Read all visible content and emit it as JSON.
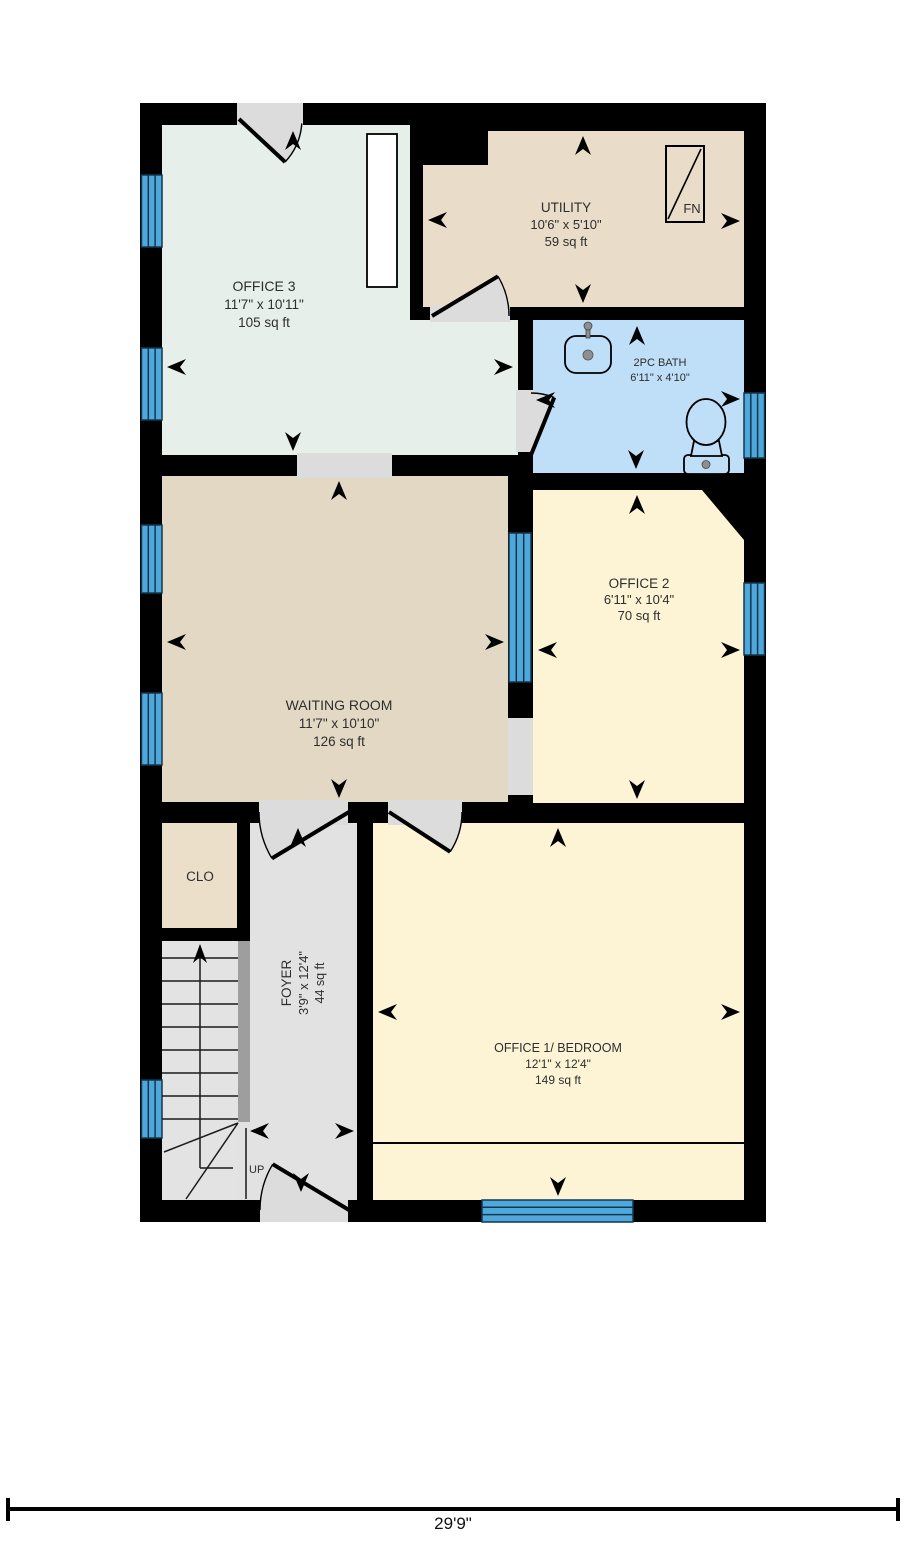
{
  "plan": {
    "scale_label": "29'9\"",
    "up_label": "UP",
    "furnace_label": "FN",
    "rooms": {
      "office3": {
        "name": "OFFICE 3",
        "dims": "11'7\" x 10'11\"",
        "area": "105 sq ft",
        "color": "#e6efe9"
      },
      "utility": {
        "name": "UTILITY",
        "dims": "10'6\" x 5'10\"",
        "area": "59 sq ft",
        "color": "#e9dcc8"
      },
      "bath": {
        "name": "2PC BATH",
        "dims": "6'11\" x 4'10\"",
        "color": "#bfdef7"
      },
      "office2": {
        "name": "OFFICE 2",
        "dims": "6'11\" x 10'4\"",
        "area": "70 sq ft",
        "color": "#fdf4d6"
      },
      "waiting": {
        "name": "WAITING ROOM",
        "dims": "11'7\" x 10'10\"",
        "area": "126 sq ft",
        "color": "#e3d8c4"
      },
      "clo": {
        "name": "CLO",
        "color": "#ebdfca"
      },
      "foyer": {
        "name": "FOYER",
        "dims": "3'9\" x 12'4\"",
        "area": "44 sq ft",
        "color": "#e2e2e2"
      },
      "office1": {
        "name": "OFFICE 1/ BEDROOM",
        "dims": "12'1\" x 12'4\"",
        "area": "149 sq ft",
        "color": "#fdf4d6"
      }
    },
    "colors": {
      "background": "#ffffff",
      "wall": "#000000",
      "window": "#4fa8dc",
      "window_frame": "#14374e",
      "opening": "#dcdcdc",
      "stairs": "#e3e3e3",
      "handrail": "#9e9e9e",
      "text": "#2e2e2e",
      "fixture_metal": "#8f8f8f"
    }
  }
}
